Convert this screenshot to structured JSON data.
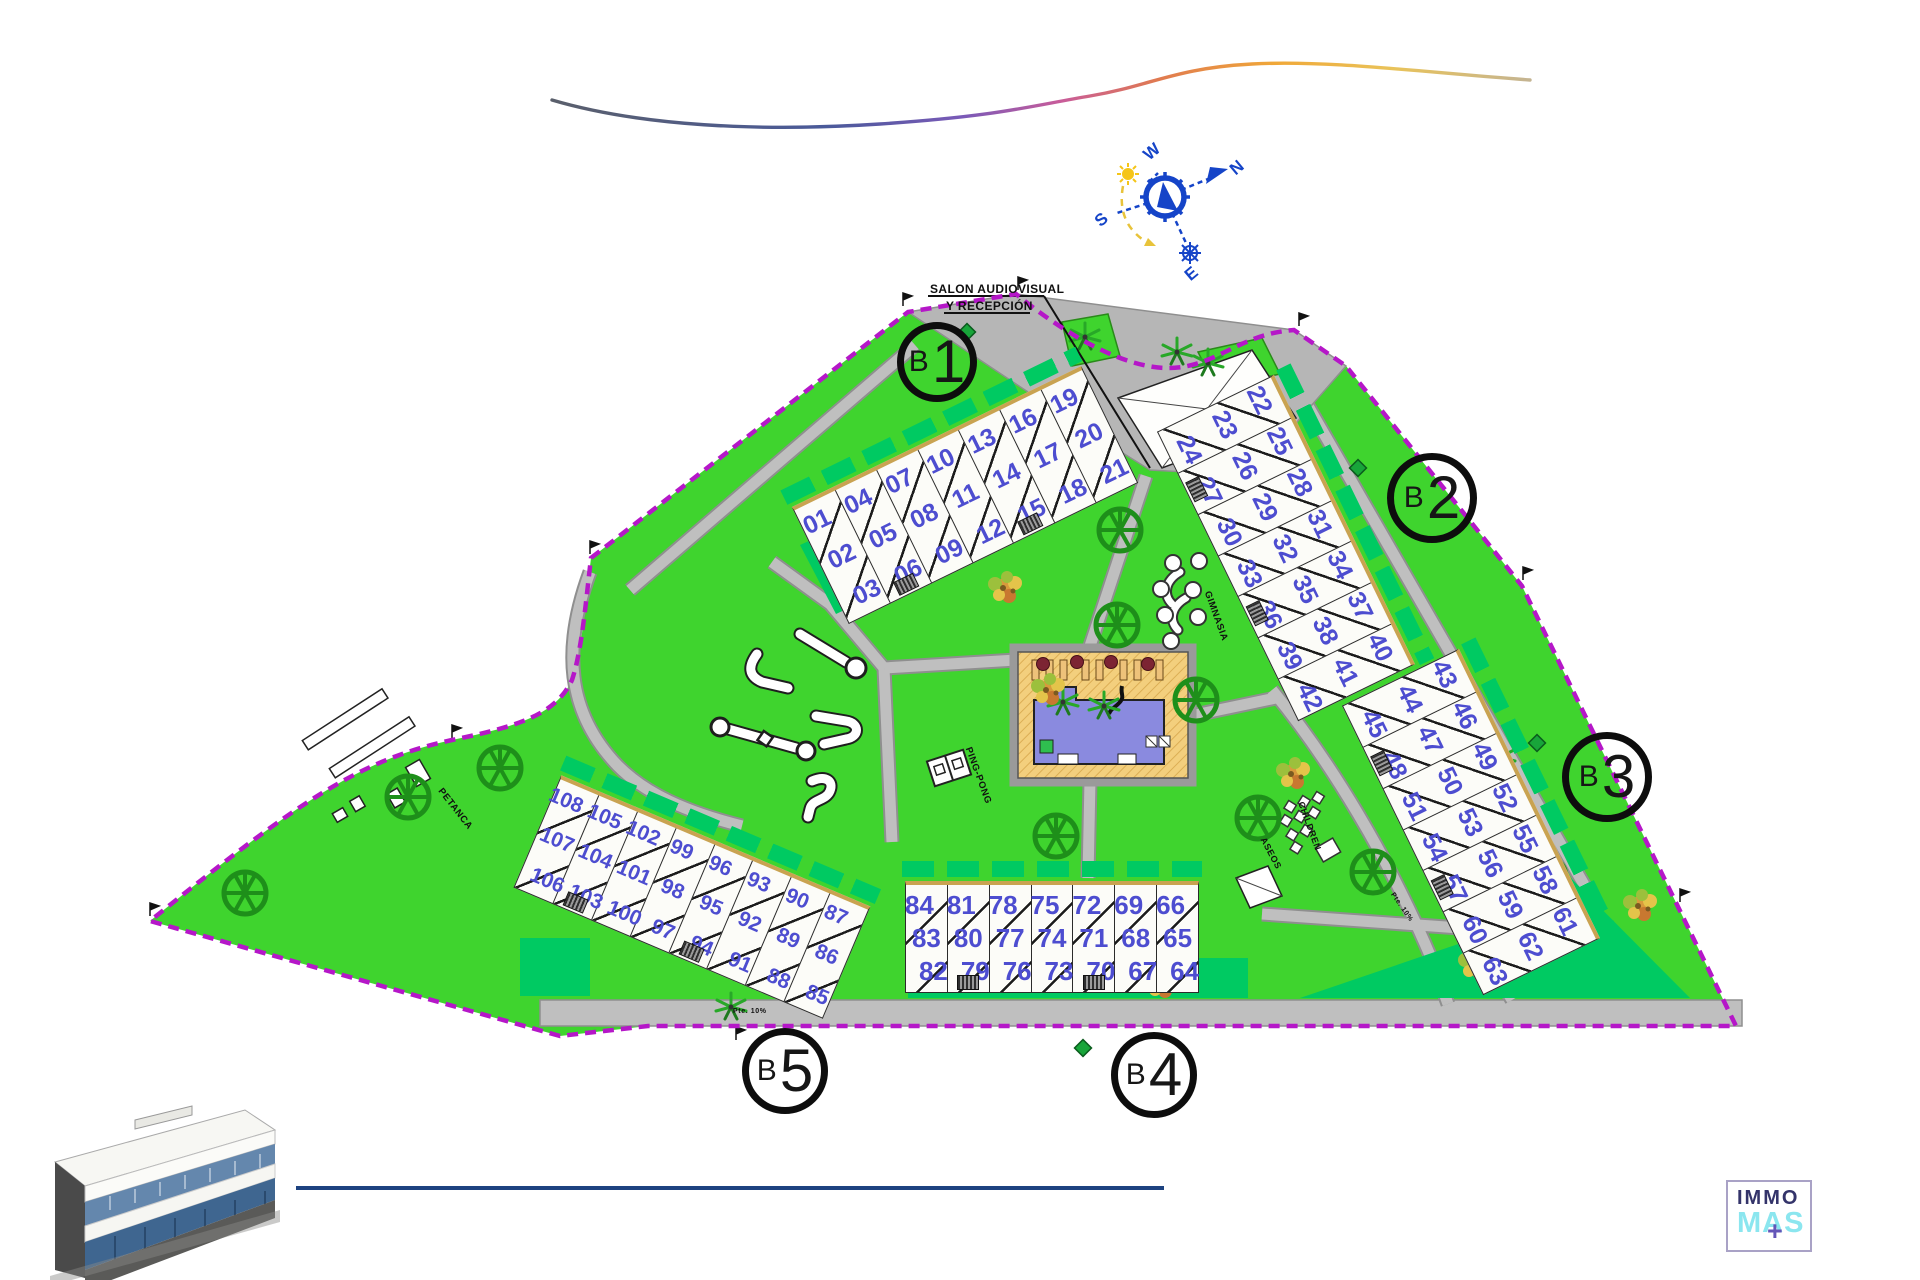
{
  "site": {
    "boundary_color": "#b517c8",
    "lawn_color": "#3fd42e",
    "garden_color": "#00ca62",
    "path_color": "#bfbfbf",
    "pool_color": "#8a8adf",
    "deck_color": "#f3cf7d",
    "unit_number_color": "#4d4dd0",
    "tree_color": "#1e8f1a"
  },
  "compass": {
    "n": "N",
    "s": "S",
    "e": "E",
    "w": "W"
  },
  "reception_label": {
    "line1": "SALON AUDIOVISUAL",
    "line2": "Y RECEPCIÓN"
  },
  "area_labels": [
    {
      "id": "petanca",
      "text": "PETANCA",
      "x": 440,
      "y": 784,
      "rot": 52,
      "size": 9.5
    },
    {
      "id": "pingpong",
      "text": "PING-PONG",
      "x": 968,
      "y": 742,
      "rot": 70,
      "size": 9.5
    },
    {
      "id": "gimnasia",
      "text": "GIMNASIA",
      "x": 1207,
      "y": 586,
      "rot": 70,
      "size": 9.5
    },
    {
      "id": "children",
      "text": "CHILDREN",
      "x": 1301,
      "y": 797,
      "rot": 70,
      "size": 9
    },
    {
      "id": "aseos",
      "text": "ASEOS",
      "x": 1263,
      "y": 833,
      "rot": 62,
      "size": 9
    },
    {
      "id": "ramp-1",
      "text": "Pte. 10%",
      "x": 733,
      "y": 1008,
      "rot": 0,
      "size": 7
    },
    {
      "id": "ramp-2",
      "text": "Pte. 10%",
      "x": 1392,
      "y": 890,
      "rot": 55,
      "size": 7
    }
  ],
  "blocks": [
    {
      "id": "b1",
      "letter": "B",
      "number": "1",
      "circle": {
        "x": 937,
        "y": 362,
        "r": 40
      },
      "building": {
        "cx": 965,
        "cy": 495,
        "angle": -26,
        "cellW": 46,
        "cellH": 130,
        "fontSize": 25,
        "units": [
          [
            "01",
            "02",
            "03"
          ],
          [
            "04",
            "05",
            "06"
          ],
          [
            "07",
            "08",
            "09"
          ],
          [
            "10",
            "11",
            "12"
          ],
          [
            "13",
            "14",
            "15"
          ],
          [
            "16",
            "17",
            "18"
          ],
          [
            "19",
            "20",
            "21"
          ]
        ]
      }
    },
    {
      "id": "b2",
      "letter": "B",
      "number": "2",
      "circle": {
        "x": 1432,
        "y": 498,
        "r": 45
      },
      "building": {
        "cx": 1286,
        "cy": 548,
        "angle": 64,
        "cellW": 46,
        "cellH": 130,
        "fontSize": 25,
        "units": [
          [
            "22",
            "23",
            "24"
          ],
          [
            "25",
            "26",
            "27"
          ],
          [
            "28",
            "29",
            "30"
          ],
          [
            "31",
            "32",
            "33"
          ],
          [
            "34",
            "35",
            "36"
          ],
          [
            "37",
            "38",
            "39"
          ],
          [
            "40",
            "41",
            "42"
          ]
        ]
      }
    },
    {
      "id": "b3",
      "letter": "B",
      "number": "3",
      "circle": {
        "x": 1607,
        "y": 777,
        "r": 45
      },
      "building": {
        "cx": 1471,
        "cy": 822,
        "angle": 64,
        "cellW": 46,
        "cellH": 130,
        "fontSize": 25,
        "units": [
          [
            "43",
            "44",
            "45"
          ],
          [
            "46",
            "47",
            "48"
          ],
          [
            "49",
            "50",
            "51"
          ],
          [
            "52",
            "53",
            "54"
          ],
          [
            "55",
            "56",
            "57"
          ],
          [
            "58",
            "59",
            "60"
          ],
          [
            "61",
            "62",
            "63"
          ]
        ]
      }
    },
    {
      "id": "b4",
      "letter": "B",
      "number": "4",
      "circle": {
        "x": 1154,
        "y": 1075,
        "r": 43
      },
      "building": {
        "cx": 1052,
        "cy": 937,
        "angle": 0,
        "cellW": 42,
        "cellH": 112,
        "fontSize": 26,
        "units": [
          [
            "84",
            "83",
            "82"
          ],
          [
            "81",
            "80",
            "79"
          ],
          [
            "78",
            "77",
            "76"
          ],
          [
            "75",
            "74",
            "73"
          ],
          [
            "72",
            "71",
            "70"
          ],
          [
            "69",
            "68",
            "67"
          ],
          [
            "66",
            "65",
            "64"
          ]
        ]
      }
    },
    {
      "id": "b5",
      "letter": "B",
      "number": "5",
      "circle": {
        "x": 785,
        "y": 1071,
        "r": 43
      },
      "building": {
        "cx": 692,
        "cy": 897,
        "angle": 23,
        "cellW": 42,
        "cellH": 122,
        "fontSize": 21,
        "units": [
          [
            "108",
            "107",
            "106"
          ],
          [
            "105",
            "104",
            "103"
          ],
          [
            "102",
            "101",
            "100"
          ],
          [
            "99",
            "98",
            "97"
          ],
          [
            "96",
            "95",
            "94"
          ],
          [
            "93",
            "92",
            "91"
          ],
          [
            "90",
            "89",
            "88"
          ],
          [
            "87",
            "86",
            "85"
          ]
        ]
      }
    }
  ],
  "logo": {
    "top": "IMMO",
    "bottom": "MAS",
    "plus": "+"
  }
}
